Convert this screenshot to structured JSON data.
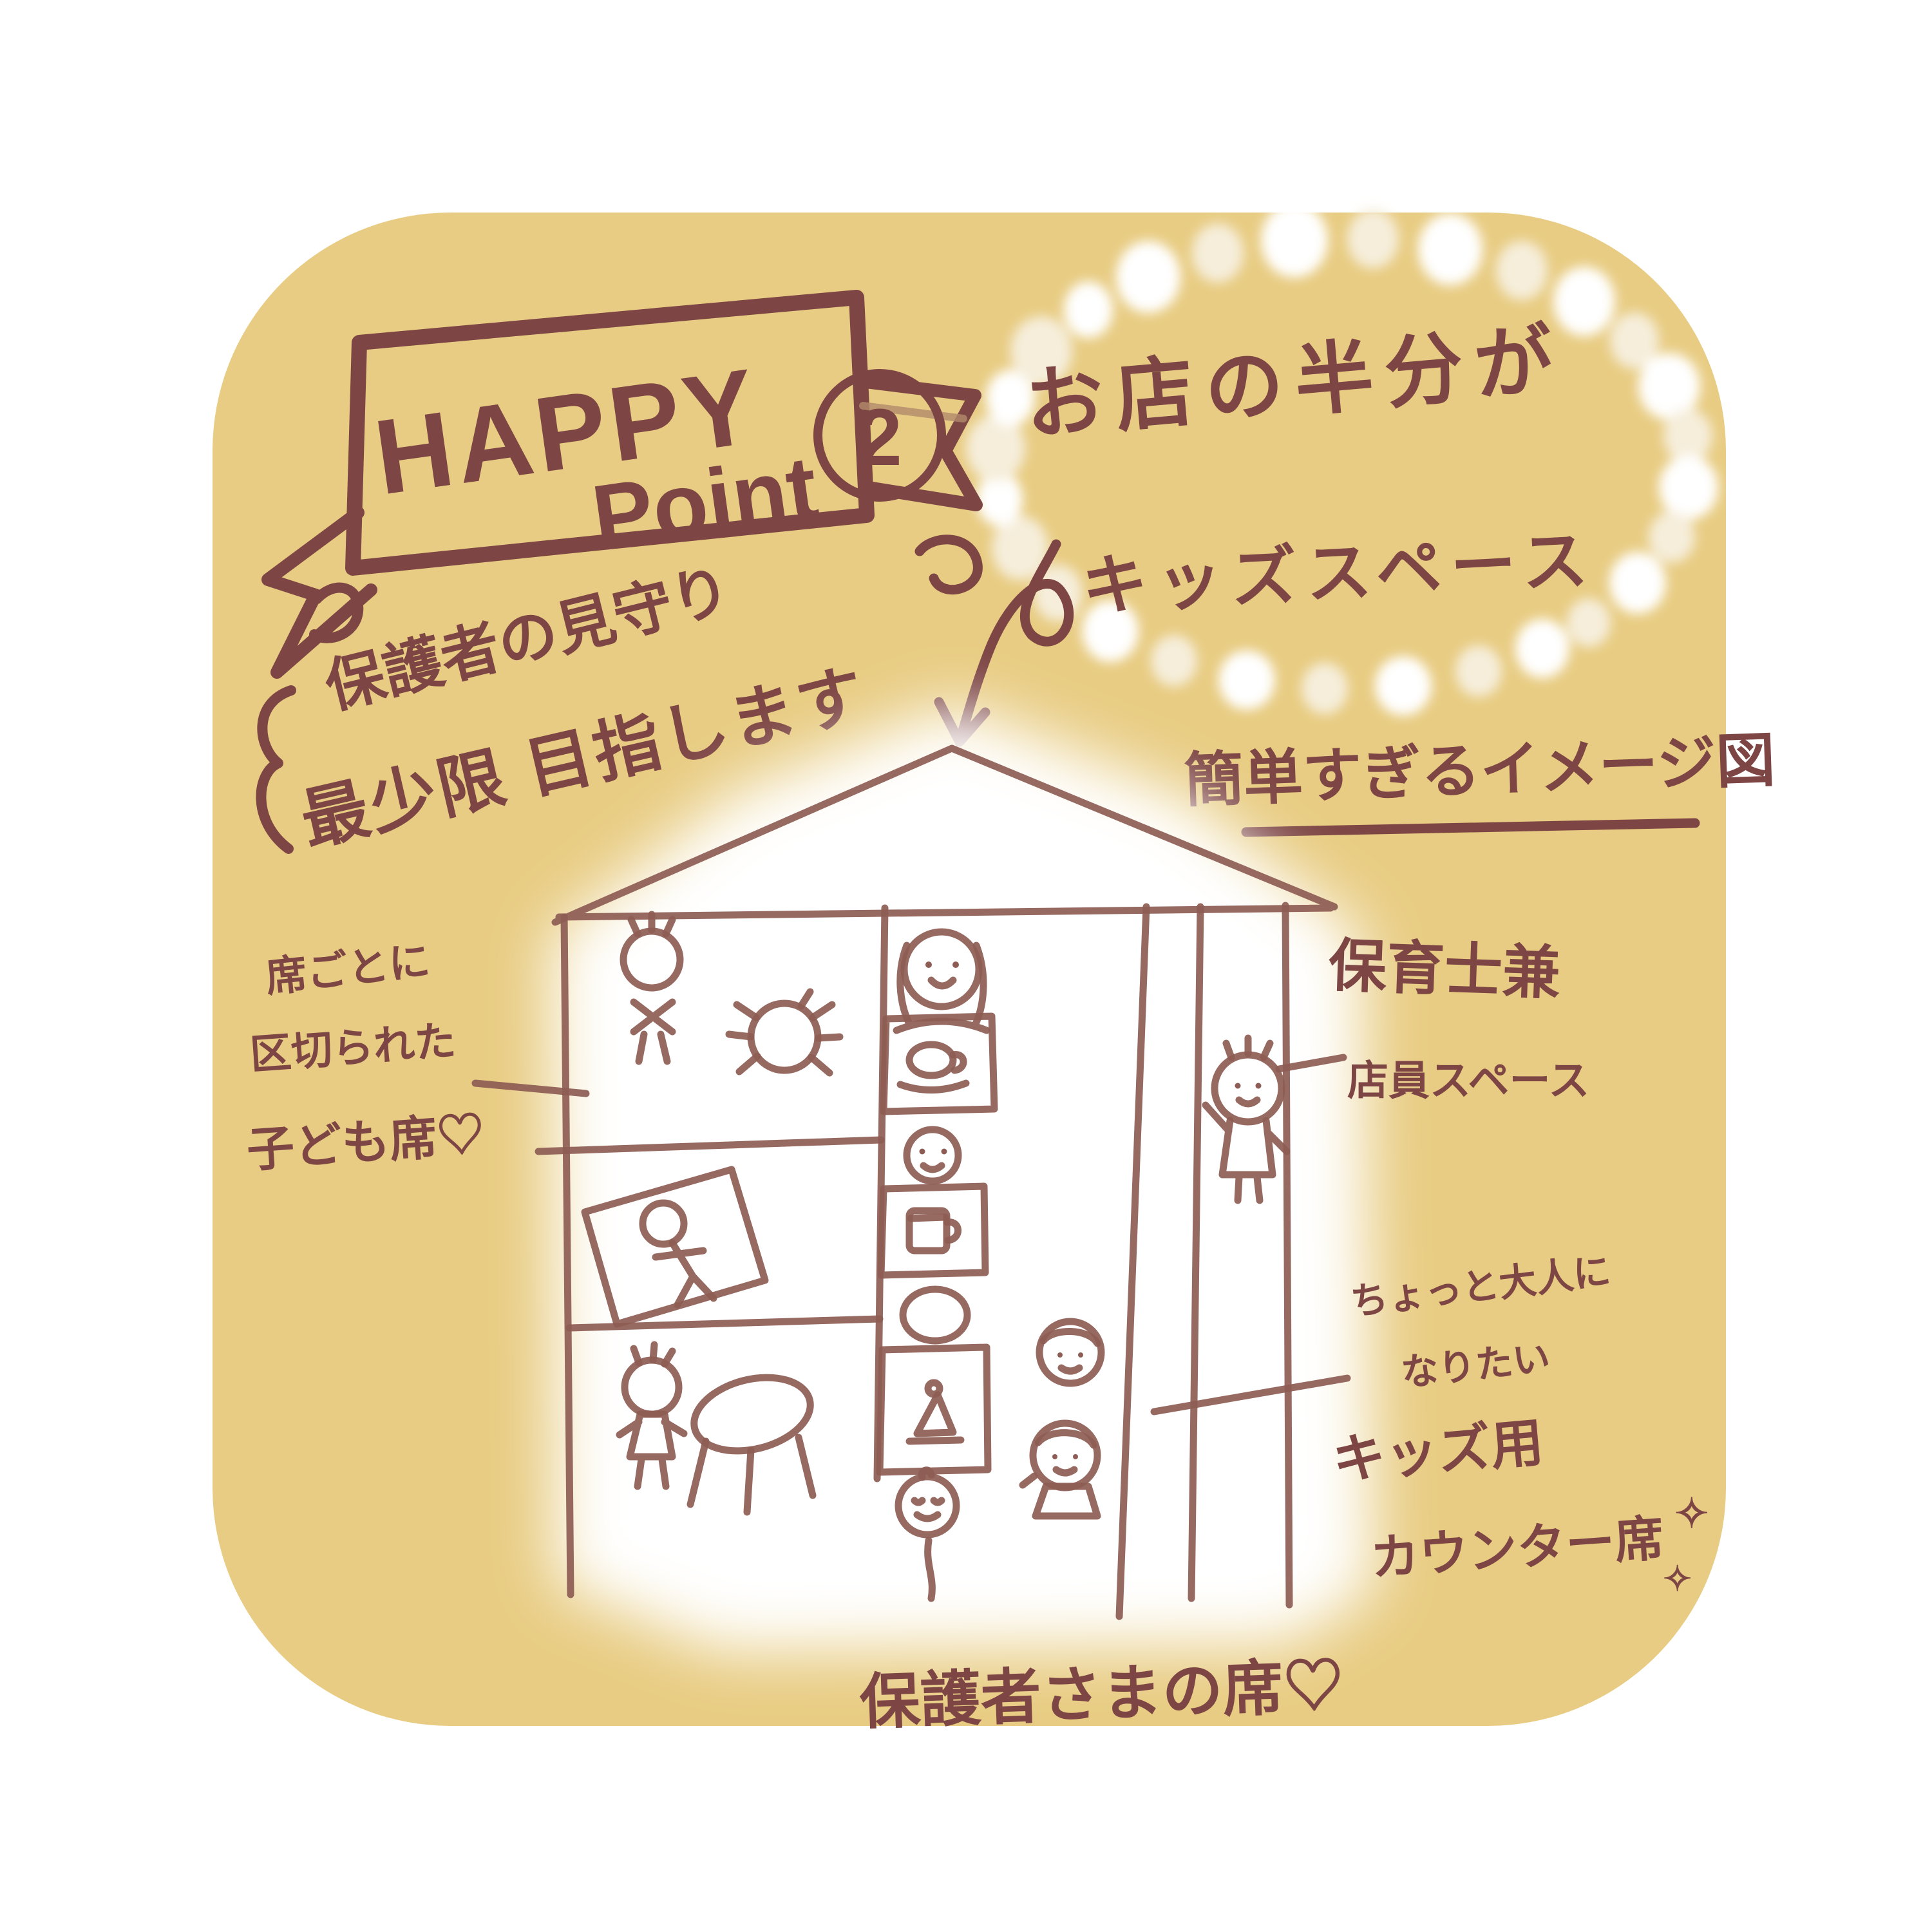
{
  "banner": {
    "word1": "HAPPY",
    "word2": "Point",
    "badge": "2"
  },
  "headline": {
    "line1": "お店の半分が",
    "line2": "キッズスペース"
  },
  "watch_note": {
    "line1": "保護者の見守り",
    "line2": "最少限 目指します"
  },
  "diagram_caption": {
    "text": "簡単すぎるイメージ図"
  },
  "labels": {
    "kids_seat": {
      "line1": "席ごとに",
      "line2": "区切られた",
      "line3": "子ども席♡"
    },
    "staff": {
      "line1": "保育士兼",
      "line2": "店員スペース"
    },
    "counter": {
      "line1": "ちょっと大人に",
      "line2": "なりたい",
      "line3": "キッズ用",
      "line4": "カウンター席"
    },
    "parents_seat": {
      "text": "保護者さまの席♡"
    }
  },
  "decor": {
    "sparkle": "✧"
  },
  "colors": {
    "background": "#ffffff",
    "card": "#e8cc83",
    "ink": "#7d4644",
    "line": "#8d5c54",
    "dot_bright": "#ffffff",
    "dot_soft": "#f6eedb",
    "glow": "#ffffff"
  }
}
